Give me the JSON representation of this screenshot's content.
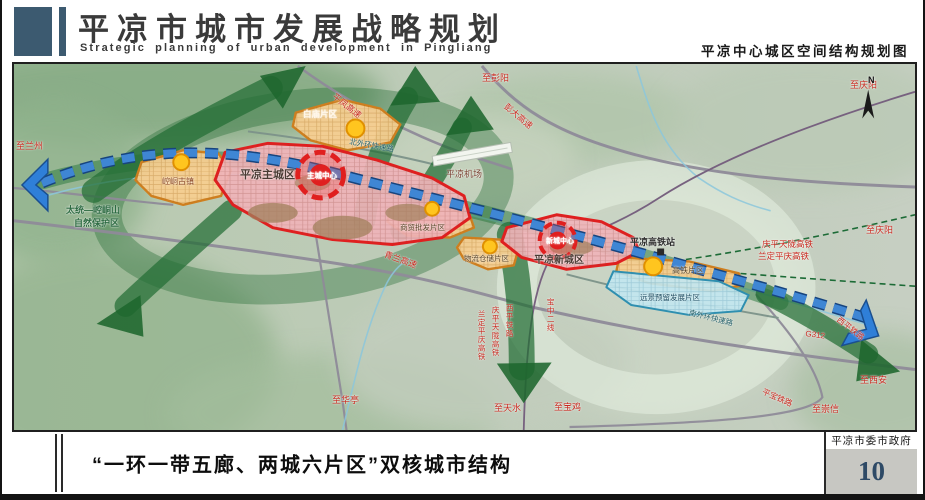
{
  "header": {
    "title": "平凉市城市发展战略规划",
    "subtitle": "Strategic planning of urban development in Pingliang",
    "caption_right": "平凉中心城区空间结构规划图"
  },
  "footer": {
    "caption": "“一环一带五廊、两城六片区”双核城市结构",
    "agency": "平凉市委市政府",
    "page_number": "10"
  },
  "colors": {
    "accent": "#3c5a70",
    "corridor_green": "#226e34",
    "belt_blue": "#3f86d4",
    "core_red": "#e01f1f",
    "district_orange": "#cf7f1f",
    "reserve_blue": "#2e8fb0",
    "page_number_blue": "#2e4a66",
    "road_label_red": "#c8281e"
  },
  "map": {
    "labels": [
      {
        "id": "to-lanzhou",
        "text": "至兰州",
        "x": 2,
        "y": 78,
        "c": "#c8281e",
        "s": 9
      },
      {
        "id": "baimiao-district",
        "text": "白庙片区",
        "x": 289,
        "y": 46,
        "c": "#fff6e8",
        "s": 8.5,
        "b": 1
      },
      {
        "id": "pingfeng-expressway",
        "text": "平凤高速",
        "x": 322,
        "y": 28,
        "c": "#c8281e",
        "s": 8.5,
        "rot": 38
      },
      {
        "id": "to-pengyang",
        "text": "至彭阳",
        "x": 468,
        "y": 10,
        "c": "#c8281e",
        "s": 9
      },
      {
        "id": "pengda-expressway",
        "text": "彭大高速",
        "x": 494,
        "y": 38,
        "c": "#c8281e",
        "s": 8.5,
        "rot": 40
      },
      {
        "id": "to-qingyang-top",
        "text": "至庆阳",
        "x": 836,
        "y": 17,
        "c": "#c8281e",
        "s": 9
      },
      {
        "id": "north-ring-expressway",
        "text": "北外环快速路",
        "x": 336,
        "y": 74,
        "c": "#1f5c64",
        "s": 7.5,
        "rot": 10
      },
      {
        "id": "main-city",
        "text": "平凉主城区",
        "x": 226,
        "y": 106,
        "c": "#4a3a33",
        "s": 11,
        "b": 1
      },
      {
        "id": "main-city-core",
        "text": "主城中心",
        "x": 308,
        "y": 112,
        "c": "#ffffff",
        "s": 7.5,
        "ctr": 1,
        "b": 1
      },
      {
        "id": "nature-reserve-line1",
        "text": "太统—崆峒山",
        "x": 52,
        "y": 142,
        "c": "#2d6b42",
        "s": 9,
        "b": 1
      },
      {
        "id": "nature-reserve-line2",
        "text": "自然保护区",
        "x": 60,
        "y": 155,
        "c": "#2d6b42",
        "s": 9,
        "b": 1
      },
      {
        "id": "kongtong-town",
        "text": "崆峒古镇",
        "x": 148,
        "y": 114,
        "c": "#8a4520",
        "s": 8
      },
      {
        "id": "airport",
        "text": "平凉机场",
        "x": 432,
        "y": 106,
        "c": "#7a4232",
        "s": 9
      },
      {
        "id": "qinglan-expressway",
        "text": "青兰高速",
        "x": 372,
        "y": 186,
        "c": "#c8281e",
        "s": 8.5,
        "rot": 20
      },
      {
        "id": "trade-wholesale-district",
        "text": "商贸批发片区",
        "x": 386,
        "y": 160,
        "c": "#5a4426",
        "s": 7.5
      },
      {
        "id": "logistics-district",
        "text": "物流仓储片区",
        "x": 450,
        "y": 191,
        "c": "#5a4426",
        "s": 7.5
      },
      {
        "id": "new-city-core",
        "text": "新城中心",
        "x": 546,
        "y": 178,
        "c": "#ffffff",
        "s": 7,
        "ctr": 1,
        "b": 1
      },
      {
        "id": "new-city",
        "text": "平凉新城区",
        "x": 520,
        "y": 192,
        "c": "#4a3a33",
        "s": 10,
        "b": 1
      },
      {
        "id": "hsr-station",
        "text": "平凉高铁站",
        "x": 616,
        "y": 174,
        "c": "#2e2e2e",
        "s": 9,
        "b": 1
      },
      {
        "id": "qingping-tianlong-hsr",
        "text": "庆平天陇高铁",
        "x": 748,
        "y": 176,
        "c": "#c8281e",
        "s": 8.5
      },
      {
        "id": "landing-pingqing-hsr",
        "text": "兰定平庆高铁",
        "x": 744,
        "y": 188,
        "c": "#c8281e",
        "s": 8.5
      },
      {
        "id": "to-qingyang-right",
        "text": "至庆阳",
        "x": 852,
        "y": 162,
        "c": "#c8281e",
        "s": 9
      },
      {
        "id": "hsr-district",
        "text": "高铁片区",
        "x": 658,
        "y": 203,
        "c": "#5a4426",
        "s": 8
      },
      {
        "id": "reserved-development-district",
        "text": "远景预留发展片区",
        "x": 626,
        "y": 230,
        "c": "#1f4e62",
        "s": 7.5
      },
      {
        "id": "south-ring-expressway",
        "text": "南外环快速路",
        "x": 676,
        "y": 245,
        "c": "#1f5c64",
        "s": 7.5,
        "rot": 14
      },
      {
        "id": "g312",
        "text": "G312",
        "x": 792,
        "y": 266,
        "c": "#c8281e",
        "s": 8,
        "rot": 8
      },
      {
        "id": "xiping-railway",
        "text": "西平铁路",
        "x": 826,
        "y": 252,
        "c": "#c8281e",
        "s": 8,
        "rot": 38
      },
      {
        "id": "to-xian",
        "text": "至西安",
        "x": 846,
        "y": 312,
        "c": "#c8281e",
        "s": 9
      },
      {
        "id": "pingbao-railway",
        "text": "平宝铁路",
        "x": 750,
        "y": 324,
        "c": "#c8281e",
        "s": 8,
        "rot": 24
      },
      {
        "id": "to-chongxin",
        "text": "至崇信",
        "x": 798,
        "y": 341,
        "c": "#c8281e",
        "s": 9
      },
      {
        "id": "to-huating",
        "text": "至华亭",
        "x": 318,
        "y": 332,
        "c": "#c8281e",
        "s": 9
      },
      {
        "id": "to-tianshui",
        "text": "至天水",
        "x": 480,
        "y": 340,
        "c": "#c8281e",
        "s": 9
      },
      {
        "id": "to-baoji",
        "text": "至宝鸡",
        "x": 540,
        "y": 339,
        "c": "#c8281e",
        "s": 9
      },
      {
        "id": "landing-pingqing-hsr-vertical",
        "text": "兰定平庆高铁",
        "x": 463,
        "y": 246,
        "c": "#c8281e",
        "s": 7.5,
        "v": 1
      },
      {
        "id": "qingping-tianlong-hsr-vertical",
        "text": "庆平天陇高铁",
        "x": 477,
        "y": 242,
        "c": "#c8281e",
        "s": 7.5,
        "v": 1
      },
      {
        "id": "xiping-railway-vertical",
        "text": "西平铁路",
        "x": 491,
        "y": 240,
        "c": "#c8281e",
        "s": 7.5,
        "v": 1
      },
      {
        "id": "baozhong-second-line",
        "text": "宝中二线",
        "x": 532,
        "y": 234,
        "c": "#c8281e",
        "s": 7.5,
        "v": 1
      },
      {
        "id": "compass-n",
        "text": "N",
        "x": 854,
        "y": 12,
        "c": "#111111",
        "s": 9,
        "b": 1
      }
    ]
  }
}
